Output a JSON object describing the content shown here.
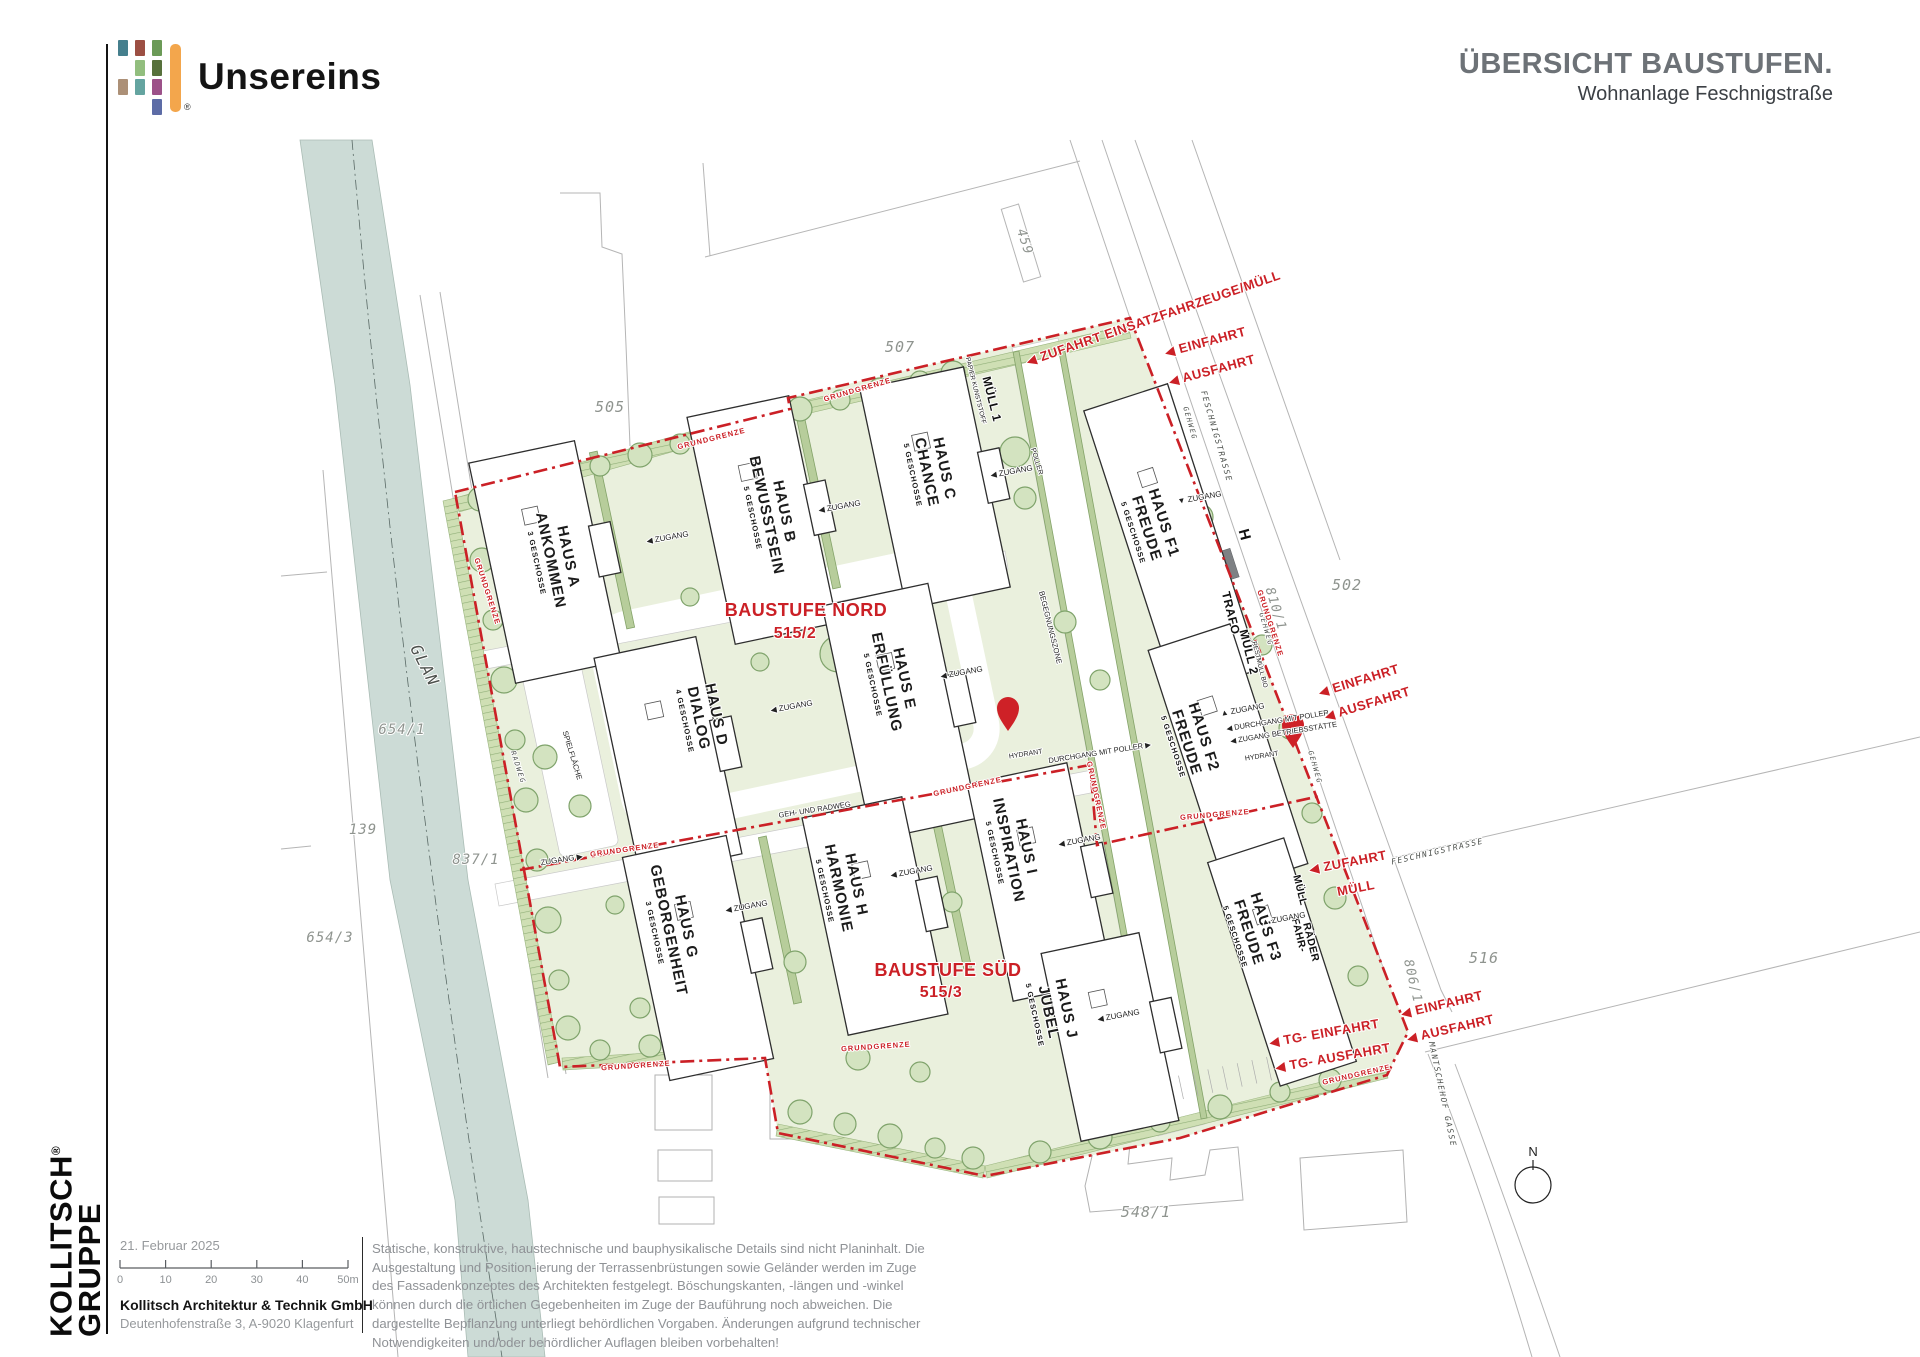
{
  "header": {
    "logo_text": "Unsereins",
    "logo_reg": "®",
    "title": "ÜBERSICHT BAUSTUFEN.",
    "subtitle": "Wohnanlage Feschnigstraße",
    "logo_colors": {
      "bar": "#F3A64C"
    },
    "logo_mosaic": [
      {
        "c": 0,
        "r": 0,
        "color": "#457F8D"
      },
      {
        "c": 1,
        "r": 0,
        "color": "#9C4F43"
      },
      {
        "c": 2,
        "r": 0,
        "color": "#6B9A57"
      },
      {
        "c": 1,
        "r": 1,
        "color": "#92BE7E"
      },
      {
        "c": 2,
        "r": 1,
        "color": "#57713C"
      },
      {
        "c": 0,
        "r": 2,
        "color": "#AC9077"
      },
      {
        "c": 1,
        "r": 2,
        "color": "#64A4A0"
      },
      {
        "c": 2,
        "r": 2,
        "color": "#9C5189"
      },
      {
        "c": 2,
        "r": 3,
        "color": "#5D6CA6"
      }
    ]
  },
  "sidebar": {
    "company_line1": "KOLLITSCH",
    "company_reg": "®",
    "company_line2": "GRUPPE"
  },
  "titleblock": {
    "date": "21. Februar 2025",
    "scale_ticks": [
      "0",
      "10",
      "20",
      "30",
      "40",
      "50m"
    ],
    "company": "Kollitsch Architektur & Technik GmbH",
    "address": "Deutenhofenstraße 3,  A-9020 Klagenfurt"
  },
  "disclaimer": {
    "text": "Statische, konstruktive, haustechnische und bauphysikalische Details sind nicht Planinhalt. Die Ausgestaltung und Position-ierung der Terrassenbrüstungen sowie Geländer werden im Zuge des Fassadenkonzeptes des Architekten festgelegt. Böschungskanten, -längen und -winkel können durch die örtlichen Gegebenheiten im Zuge der Bauführung noch abweichen. Die dargestellte Bepflanzung unterliegt behördlichen Vorgaben. Änderungen aufgrund technischer Notwendigkeiten und/oder behördlicher Auflagen bleiben vorbehalten!"
  },
  "plan": {
    "colors": {
      "boundary_red": "#cb2026",
      "site_green": "#eaf0dd",
      "river": "#ccdbd6",
      "tree": "#d3e3c0"
    },
    "houses": [
      {
        "id": "HAUS A",
        "name": "ANKOMMEN",
        "fl": "3 GESCHOSSE",
        "x": 545,
        "y": 562,
        "w": 108,
        "h": 225,
        "rot": -12,
        "lx": 552,
        "ly": 560,
        "lr": 78
      },
      {
        "id": "HAUS B",
        "name": "BEWUSSTSEIN",
        "fl": "5 GESCHOSSE",
        "x": 762,
        "y": 520,
        "w": 104,
        "h": 232,
        "rot": -12,
        "lx": 768,
        "ly": 515,
        "lr": 78
      },
      {
        "id": "HAUS C",
        "name": "CHANCE",
        "fl": "5 GESCHOSSE",
        "x": 935,
        "y": 488,
        "w": 106,
        "h": 225,
        "rot": -12,
        "lx": 928,
        "ly": 472,
        "lr": 78
      },
      {
        "id": "HAUS D",
        "name": "DIALOG",
        "fl": "4 GESCHOSSE",
        "x": 668,
        "y": 756,
        "w": 104,
        "h": 222,
        "rot": -12,
        "lx": 700,
        "ly": 718,
        "lr": 78
      },
      {
        "id": "HAUS E",
        "name": "ERFÜLLUNG",
        "fl": "5 GESCHOSSE",
        "x": 900,
        "y": 712,
        "w": 108,
        "h": 240,
        "rot": -12,
        "lx": 888,
        "ly": 682,
        "lr": 78
      },
      {
        "id": "HAUS F1",
        "name": "FREUDE",
        "fl": "5 GESCHOSSE",
        "x": 1172,
        "y": 540,
        "w": 88,
        "h": 300,
        "rot": -18,
        "lx": 1148,
        "ly": 528,
        "lr": 72,
        "f": 1
      },
      {
        "id": "HAUS F2",
        "name": "FREUDE",
        "fl": "5 GESCHOSSE",
        "x": 1228,
        "y": 757,
        "w": 86,
        "h": 252,
        "rot": -18,
        "lx": 1188,
        "ly": 742,
        "lr": 72,
        "f": 1
      },
      {
        "id": "HAUS F3",
        "name": "FREUDE",
        "fl": "5 GESCHOSSE",
        "x": 1282,
        "y": 962,
        "w": 80,
        "h": 235,
        "rot": -18,
        "lx": 1250,
        "ly": 932,
        "lr": 72,
        "f": 1
      },
      {
        "id": "HAUS G",
        "name": "GEBORGENHEIT",
        "fl": "3 GESCHOSSE",
        "x": 698,
        "y": 958,
        "w": 106,
        "h": 228,
        "rot": -12,
        "lx": 670,
        "ly": 930,
        "lr": 78
      },
      {
        "id": "HAUS H",
        "name": "HARMONIE",
        "fl": "5 GESCHOSSE",
        "x": 875,
        "y": 916,
        "w": 102,
        "h": 222,
        "rot": -12,
        "lx": 840,
        "ly": 888,
        "lr": 78
      },
      {
        "id": "HAUS I",
        "name": "INSPIRATION",
        "fl": "5 GESCHOSSE",
        "x": 1040,
        "y": 882,
        "w": 102,
        "h": 222,
        "rot": -12,
        "lx": 1010,
        "ly": 850,
        "lr": 78
      },
      {
        "id": "HAUS J",
        "name": "JUBEL",
        "fl": "5 GESCHOSSE",
        "x": 1110,
        "y": 1037,
        "w": 100,
        "h": 192,
        "rot": -12,
        "lx": 1050,
        "ly": 1012,
        "lr": 78
      }
    ],
    "stage_labels": [
      {
        "t": "BAUSTUFE NORD",
        "x": 806,
        "y": 616,
        "r": 0,
        "s": 18,
        "k": "stage"
      },
      {
        "t": "515/2",
        "x": 795,
        "y": 638,
        "r": 0,
        "s": 16,
        "k": "stage"
      },
      {
        "t": "BAUSTUFE SÜD",
        "x": 948,
        "y": 976,
        "r": 0,
        "s": 18,
        "k": "stage"
      },
      {
        "t": "515/3",
        "x": 941,
        "y": 997,
        "r": 0,
        "s": 16,
        "k": "stage"
      }
    ],
    "labels": [
      {
        "t": "459",
        "x": 1021,
        "y": 243,
        "r": 72,
        "s": 13,
        "k": "parcel"
      },
      {
        "t": "507",
        "x": 900,
        "y": 352,
        "r": 0,
        "s": 15,
        "k": "parcel"
      },
      {
        "t": "505",
        "x": 610,
        "y": 412,
        "r": 0,
        "s": 15,
        "k": "parcel"
      },
      {
        "t": "502",
        "x": 1347,
        "y": 590,
        "r": 0,
        "s": 15,
        "k": "parcel"
      },
      {
        "t": "810/1",
        "x": 1272,
        "y": 610,
        "r": 73,
        "s": 13,
        "k": "parcel"
      },
      {
        "t": "516",
        "x": 1484,
        "y": 963,
        "r": 0,
        "s": 15,
        "k": "parcel"
      },
      {
        "t": "806/1",
        "x": 1409,
        "y": 982,
        "r": 77,
        "s": 13,
        "k": "parcel"
      },
      {
        "t": "548/1",
        "x": 1146,
        "y": 1217,
        "r": 0,
        "s": 15,
        "k": "parcel"
      },
      {
        "t": "654/1",
        "x": 402,
        "y": 734,
        "r": 0,
        "s": 14,
        "k": "parcel"
      },
      {
        "t": "139",
        "x": 363,
        "y": 834,
        "r": 0,
        "s": 14,
        "k": "parcel"
      },
      {
        "t": "837/1",
        "x": 476,
        "y": 864,
        "r": 0,
        "s": 14,
        "k": "parcel"
      },
      {
        "t": "654/3",
        "x": 330,
        "y": 942,
        "r": 0,
        "s": 14,
        "k": "parcel"
      },
      {
        "t": "GLAN",
        "x": 420,
        "y": 668,
        "r": 63,
        "s": 16,
        "k": "street"
      },
      {
        "t": "FESCHNIGSTRASSE",
        "x": 1214,
        "y": 437,
        "r": 74,
        "s": 8,
        "k": "street"
      },
      {
        "t": "FESCHNIGSTRASSE",
        "x": 1438,
        "y": 854,
        "r": -13,
        "s": 8,
        "k": "street"
      },
      {
        "t": "MANTSCHEHOF GASSE",
        "x": 1440,
        "y": 1095,
        "r": 78,
        "s": 8,
        "k": "street"
      },
      {
        "t": "GEHWEG",
        "x": 1188,
        "y": 424,
        "r": 74,
        "s": 7,
        "k": "street"
      },
      {
        "t": "GEHWEG",
        "x": 1264,
        "y": 630,
        "r": 74,
        "s": 7,
        "k": "street"
      },
      {
        "t": "GEHWEG",
        "x": 1313,
        "y": 768,
        "r": 74,
        "s": 7,
        "k": "street"
      },
      {
        "t": "RADWEG",
        "x": 516,
        "y": 768,
        "r": 72,
        "s": 7,
        "k": "street"
      },
      {
        "t": "GEH- UND RADWEG",
        "x": 815,
        "y": 812,
        "r": -9,
        "s": 7.5,
        "k": "small"
      },
      {
        "t": "BEGEGNUNGSZONE",
        "x": 1048,
        "y": 628,
        "r": 76,
        "s": 7.5,
        "k": "small"
      },
      {
        "t": "SPIELFLÄCHE",
        "x": 570,
        "y": 756,
        "r": 73,
        "s": 7.5,
        "k": "small"
      },
      {
        "t": "POLLER",
        "x": 1035,
        "y": 462,
        "r": 73,
        "s": 7,
        "k": "small"
      },
      {
        "t": "N",
        "x": 1533,
        "y": 1156,
        "r": 0,
        "s": 13,
        "k": "small"
      },
      {
        "t": "H",
        "x": 1240,
        "y": 536,
        "r": 75,
        "s": 15,
        "k": "bold"
      },
      {
        "t": "TRAFO",
        "x": 1227,
        "y": 614,
        "r": 76,
        "s": 12,
        "k": "bold"
      },
      {
        "t": "MÜLL 2",
        "x": 1245,
        "y": 653,
        "r": 76,
        "s": 12,
        "k": "bold"
      },
      {
        "t": "RESTMÜLL BIO",
        "x": 1258,
        "y": 665,
        "r": 76,
        "s": 6.5,
        "k": "small"
      },
      {
        "t": "MÜLL 1",
        "x": 988,
        "y": 400,
        "r": 76,
        "s": 12,
        "k": "bold"
      },
      {
        "t": "PAPIER KUNSTSTOFF",
        "x": 974,
        "y": 391,
        "r": 76,
        "s": 6.5,
        "k": "small"
      },
      {
        "t": "MÜLL",
        "x": 1297,
        "y": 891,
        "r": 76,
        "s": 10.5,
        "k": "bold"
      },
      {
        "t": "FAHR-",
        "x": 1296,
        "y": 936,
        "r": 76,
        "s": 10.5,
        "k": "bold"
      },
      {
        "t": "RÄDER",
        "x": 1308,
        "y": 943,
        "r": 76,
        "s": 10.5,
        "k": "bold"
      },
      {
        "t": "HYDRANT",
        "x": 1026,
        "y": 756,
        "r": -9,
        "s": 7,
        "k": "small"
      },
      {
        "t": "HYDRANT",
        "x": 1262,
        "y": 758,
        "r": -9,
        "s": 7,
        "k": "small"
      },
      {
        "t": "◀ ZUGANG",
        "x": 668,
        "y": 540,
        "r": -10,
        "s": 8,
        "k": "small"
      },
      {
        "t": "◀ ZUGANG",
        "x": 840,
        "y": 509,
        "r": -10,
        "s": 8,
        "k": "small"
      },
      {
        "t": "◀ ZUGANG",
        "x": 1012,
        "y": 474,
        "r": -10,
        "s": 8,
        "k": "small"
      },
      {
        "t": "▼ ZUGANG",
        "x": 1200,
        "y": 500,
        "r": -10,
        "s": 8,
        "k": "small"
      },
      {
        "t": "◀ ZUGANG",
        "x": 792,
        "y": 709,
        "r": -10,
        "s": 8,
        "k": "small"
      },
      {
        "t": "◀ ZUGANG",
        "x": 962,
        "y": 675,
        "r": -10,
        "s": 8,
        "k": "small"
      },
      {
        "t": "▲ ZUGANG",
        "x": 1243,
        "y": 712,
        "r": -10,
        "s": 8,
        "k": "small"
      },
      {
        "t": "◀ DURCHGANG MIT POLLER",
        "x": 1278,
        "y": 723,
        "r": -9,
        "s": 7.5,
        "k": "small"
      },
      {
        "t": "◀ ZUGANG BETRIEBSSTÄTTE",
        "x": 1284,
        "y": 735,
        "r": -9,
        "s": 7.5,
        "k": "small"
      },
      {
        "t": "◀ ZUGANG",
        "x": 747,
        "y": 909,
        "r": -10,
        "s": 8,
        "k": "small"
      },
      {
        "t": "◀ ZUGANG",
        "x": 912,
        "y": 874,
        "r": -10,
        "s": 8,
        "k": "small"
      },
      {
        "t": "◀ ZUGANG",
        "x": 1080,
        "y": 843,
        "r": -10,
        "s": 8,
        "k": "small"
      },
      {
        "t": "◀ ZUGANG",
        "x": 1119,
        "y": 1018,
        "r": -10,
        "s": 8,
        "k": "small"
      },
      {
        "t": "▲ ZUGANG",
        "x": 1284,
        "y": 921,
        "r": -10,
        "s": 8,
        "k": "small"
      },
      {
        "t": "ZUGANG ▶",
        "x": 562,
        "y": 862,
        "r": -9,
        "s": 8,
        "k": "small"
      },
      {
        "t": "DURCHGANG MIT POLLER ▶",
        "x": 1100,
        "y": 755,
        "r": -9,
        "s": 7.5,
        "k": "small"
      },
      {
        "t": "◀ ZUFAHRT EINSATZFAHRZEUGE/MÜLL",
        "x": 1028,
        "y": 366,
        "r": -19,
        "s": 13,
        "k": "red",
        "a": "s"
      },
      {
        "t": "◀ EINFAHRT",
        "x": 1166,
        "y": 357,
        "r": -15,
        "s": 13,
        "k": "red",
        "a": "s"
      },
      {
        "t": "◀ AUSFAHRT",
        "x": 1170,
        "y": 386,
        "r": -15,
        "s": 13,
        "k": "red",
        "a": "s"
      },
      {
        "t": "◀ EINFAHRT",
        "x": 1320,
        "y": 697,
        "r": -17,
        "s": 13,
        "k": "red",
        "a": "s"
      },
      {
        "t": "◀ AUSFAHRT",
        "x": 1326,
        "y": 721,
        "r": -17,
        "s": 13,
        "k": "red",
        "a": "s"
      },
      {
        "t": "◀ ZUFAHRT",
        "x": 1310,
        "y": 874,
        "r": -11,
        "s": 13,
        "k": "red",
        "a": "s"
      },
      {
        "t": "MÜLL",
        "x": 1338,
        "y": 896,
        "r": -11,
        "s": 13,
        "k": "red",
        "a": "s"
      },
      {
        "t": "◀ EINFAHRT",
        "x": 1402,
        "y": 1018,
        "r": -13,
        "s": 13,
        "k": "red",
        "a": "s"
      },
      {
        "t": "◀ AUSFAHRT",
        "x": 1408,
        "y": 1043,
        "r": -13,
        "s": 13,
        "k": "red",
        "a": "s"
      },
      {
        "t": "◀ TG- EINFAHRT",
        "x": 1270,
        "y": 1047,
        "r": -10,
        "s": 13,
        "k": "red",
        "a": "s"
      },
      {
        "t": "◀ TG- AUSFAHRT",
        "x": 1276,
        "y": 1072,
        "r": -10,
        "s": 13,
        "k": "red",
        "a": "s"
      },
      {
        "t": "GRUNDGRENZE",
        "x": 712,
        "y": 441,
        "r": -14,
        "s": 7.5,
        "k": "grund"
      },
      {
        "t": "GRUNDGRENZE",
        "x": 858,
        "y": 392,
        "r": -16,
        "s": 7.5,
        "k": "grund"
      },
      {
        "t": "GRUNDGRENZE",
        "x": 485,
        "y": 592,
        "r": 72,
        "s": 7.5,
        "k": "grund"
      },
      {
        "t": "GRUNDGRENZE",
        "x": 625,
        "y": 852,
        "r": -8,
        "s": 7.5,
        "k": "grund"
      },
      {
        "t": "GRUNDGRENZE",
        "x": 636,
        "y": 1068,
        "r": -4,
        "s": 7.5,
        "k": "grund"
      },
      {
        "t": "GRUNDGRENZE",
        "x": 876,
        "y": 1049,
        "r": -4,
        "s": 7.5,
        "k": "grund"
      },
      {
        "t": "GRUNDGRENZE",
        "x": 968,
        "y": 789,
        "r": -12,
        "s": 7.5,
        "k": "grund"
      },
      {
        "t": "GRUNDGRENZE",
        "x": 1094,
        "y": 796,
        "r": 78,
        "s": 7.5,
        "k": "grund"
      },
      {
        "t": "GRUNDGRENZE",
        "x": 1215,
        "y": 817,
        "r": -5,
        "s": 7.5,
        "k": "grund"
      },
      {
        "t": "GRUNDGRENZE",
        "x": 1268,
        "y": 624,
        "r": 72,
        "s": 7.5,
        "k": "grund"
      },
      {
        "t": "GRUNDGRENZE",
        "x": 1357,
        "y": 1077,
        "r": -13,
        "s": 7.5,
        "k": "grund"
      }
    ],
    "hydrants": [
      [
        1008,
        731
      ],
      [
        1293,
        748
      ]
    ],
    "trees": [
      [
        480,
        499,
        12
      ],
      [
        520,
        488,
        10
      ],
      [
        560,
        477,
        13
      ],
      [
        600,
        466,
        10
      ],
      [
        640,
        455,
        12
      ],
      [
        680,
        444,
        10
      ],
      [
        720,
        433,
        13
      ],
      [
        760,
        422,
        10
      ],
      [
        800,
        409,
        12
      ],
      [
        840,
        400,
        10
      ],
      [
        880,
        390,
        12
      ],
      [
        920,
        381,
        10
      ],
      [
        953,
        373,
        12
      ],
      [
        482,
        560,
        12
      ],
      [
        493,
        620,
        10
      ],
      [
        504,
        680,
        13
      ],
      [
        515,
        740,
        10
      ],
      [
        526,
        800,
        12
      ],
      [
        537,
        860,
        11
      ],
      [
        548,
        920,
        13
      ],
      [
        559,
        980,
        10
      ],
      [
        568,
        1028,
        12
      ],
      [
        600,
        1050,
        10
      ],
      [
        650,
        1046,
        11
      ],
      [
        702,
        1043,
        10
      ],
      [
        800,
        1112,
        12
      ],
      [
        845,
        1124,
        11
      ],
      [
        890,
        1136,
        12
      ],
      [
        935,
        1148,
        10
      ],
      [
        973,
        1158,
        11
      ],
      [
        1040,
        1152,
        11
      ],
      [
        1100,
        1137,
        12
      ],
      [
        1160,
        1122,
        10
      ],
      [
        1220,
        1107,
        12
      ],
      [
        1280,
        1092,
        10
      ],
      [
        1330,
        1080,
        11
      ],
      [
        1015,
        452,
        15
      ],
      [
        1025,
        498,
        11
      ],
      [
        1200,
        517,
        13
      ],
      [
        1222,
        590,
        11
      ],
      [
        1262,
        645,
        10
      ],
      [
        1290,
        728,
        11
      ],
      [
        1312,
        813,
        10
      ],
      [
        1335,
        898,
        11
      ],
      [
        1358,
        976,
        10
      ],
      [
        838,
        654,
        18
      ],
      [
        864,
        700,
        12
      ],
      [
        600,
        640,
        10
      ],
      [
        545,
        757,
        12
      ],
      [
        580,
        806,
        11
      ],
      [
        760,
        662,
        9
      ],
      [
        962,
        562,
        11
      ],
      [
        690,
        597,
        9
      ],
      [
        640,
        1008,
        10
      ],
      [
        795,
        962,
        11
      ],
      [
        952,
        902,
        10
      ],
      [
        1082,
        948,
        9
      ],
      [
        858,
        1058,
        12
      ],
      [
        920,
        1072,
        10
      ],
      [
        615,
        905,
        9
      ],
      [
        1065,
        622,
        11
      ],
      [
        1100,
        680,
        10
      ]
    ]
  }
}
